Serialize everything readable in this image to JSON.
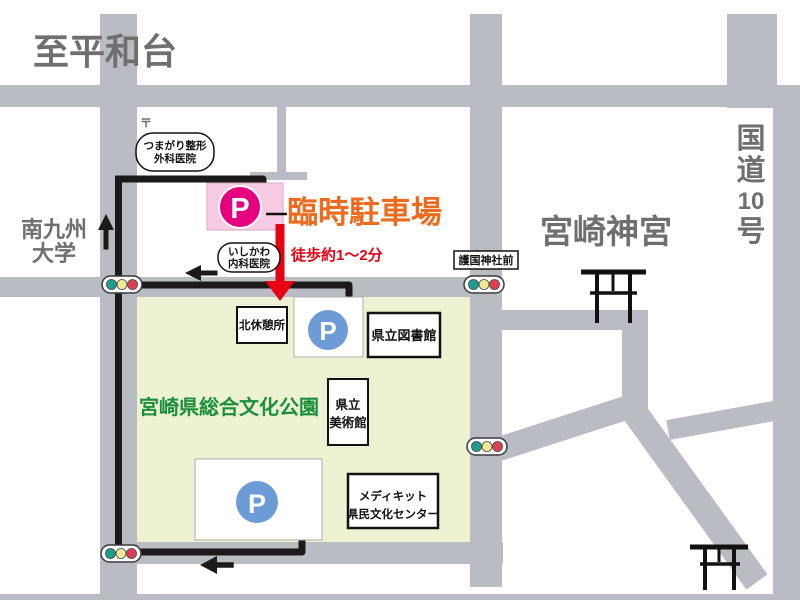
{
  "colors": {
    "road": "#b9bdc3",
    "park": "#edf2d2",
    "path": "#1a1a1a",
    "pink": "#f7cbe1",
    "magenta": "#e5007f",
    "blue": "#6d9bd5",
    "orange": "#ed6b1e",
    "red": "#e60012",
    "green_text": "#1b8e3d",
    "gray_text": "#6f6f6f"
  },
  "areas": {
    "heiwadai": "至平和台",
    "university": {
      "line1": "南九州",
      "line2": "大学"
    },
    "shrine": "宮崎神宮",
    "route10": {
      "char1": "国",
      "char2": "道",
      "char3": "10",
      "char4": "号"
    },
    "park_name": "宮崎県総合文化公園"
  },
  "parking": {
    "label": "臨時駐車場",
    "walk_note": "徒歩約1〜2分",
    "p_symbol": "P"
  },
  "landmarks": {
    "clinic_tsumagari": {
      "line1": "つまがり整形",
      "line2": "外科医院"
    },
    "clinic_ishikawa": {
      "line1": "いしかわ",
      "line2": "内科医院"
    },
    "gokoku_stop": "護国神社前",
    "rest_area": "北休憩所",
    "library": "県立図書館",
    "museum": {
      "line1": "県立",
      "line2": "美術館"
    },
    "medikit": {
      "line1": "メディキット",
      "line2": "県民文化センター"
    },
    "postal_mark": "〒"
  }
}
